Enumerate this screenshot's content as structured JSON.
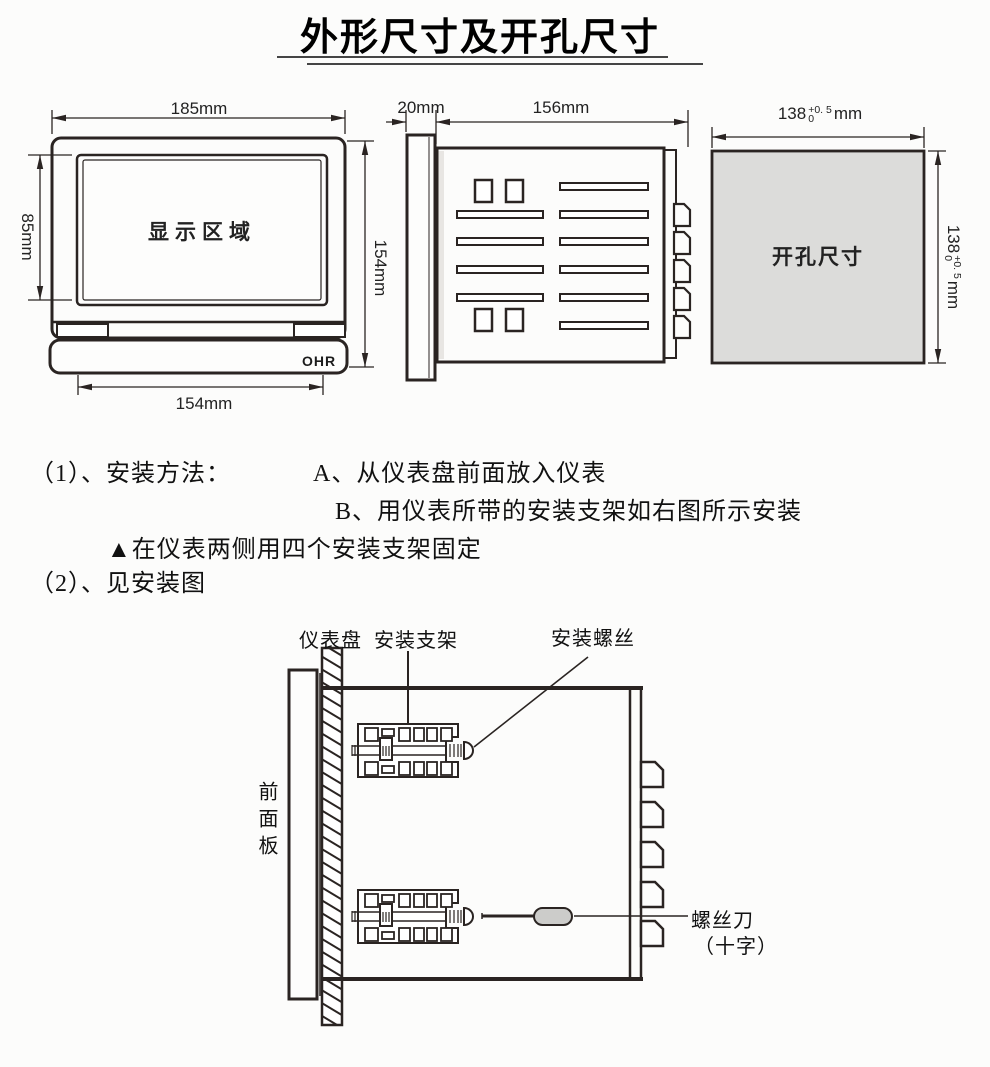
{
  "title": "外形尺寸及开孔尺寸",
  "front_view": {
    "display_label": "显示区域",
    "logo": "OHR",
    "dim_width_top": "185mm",
    "dim_display_height": "85mm",
    "dim_total_height": "154mm",
    "dim_width_bottom": "154mm"
  },
  "side_view": {
    "dim_bezel_depth": "20mm",
    "dim_body_depth": "156mm"
  },
  "cutout_view": {
    "label": "开孔尺寸",
    "dim_value": "138",
    "tol_plus": "+0. 5",
    "tol_zero": "0",
    "unit": "mm"
  },
  "instructions": {
    "item1": "（1）、安装方法：",
    "step_a": "A、从仪表盘前面放入仪表",
    "step_b": "B、用仪表所带的安装支架如右图所示安装",
    "note": "▲在仪表两侧用四个安装支架固定",
    "item2": "（2）、见安装图"
  },
  "install_diagram": {
    "panel_label": "仪表盘",
    "bracket_label": "安装支架",
    "screw_label": "安装螺丝",
    "front_panel_label": "前面板",
    "screwdriver_label": "螺丝刀",
    "screwdriver_type": "（十字）"
  }
}
